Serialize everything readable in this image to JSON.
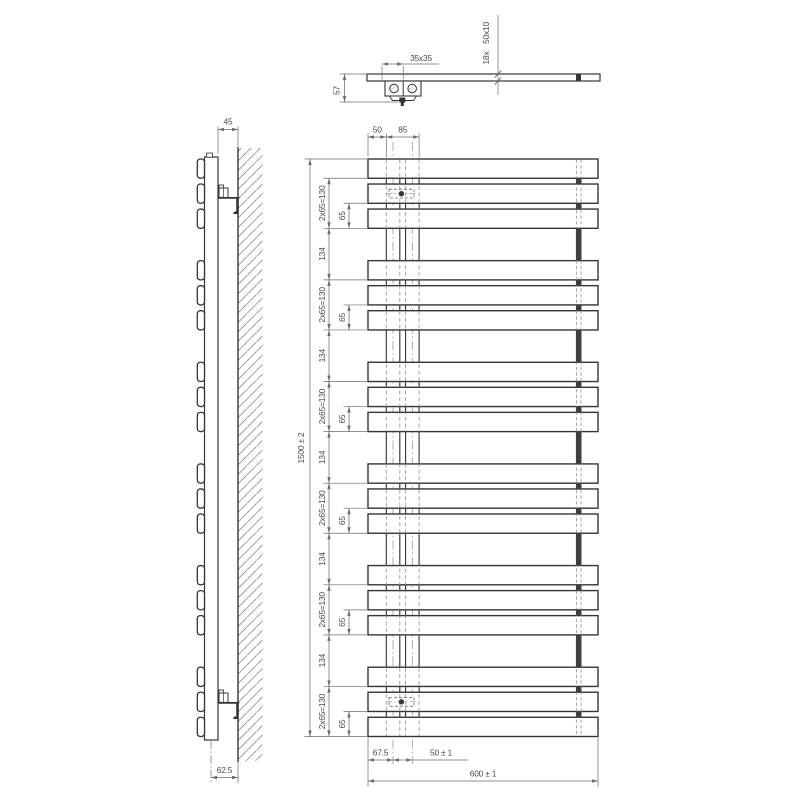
{
  "top_view": {
    "tube_section_label": "35x35",
    "slat_count_label": "18x",
    "slat_profile_label": "50x10",
    "depth_label": "57"
  },
  "side_view": {
    "wall_clearance_label": "45",
    "axis_to_wall_label": "62.5"
  },
  "front_view": {
    "overall_height_label": "1500 ± 2",
    "overall_width_label": "600 ± 1",
    "end_to_tube_label": "50",
    "tube_span_label": "85",
    "end_to_axis_label": "67.5",
    "axis_spacing_label": "50 ± 1",
    "group_span_label": "2x65=130",
    "slat_pitch_label": "65",
    "group_gap_label": "134",
    "group_count": 6,
    "slats_per_group": 3,
    "slat_total": 18
  },
  "colors": {
    "line": "#353535",
    "dim": "#6b6b6b",
    "hidden": "#979797",
    "text": "#4a4a4a",
    "hatch": "#8f8f8f",
    "background": "#ffffff"
  }
}
